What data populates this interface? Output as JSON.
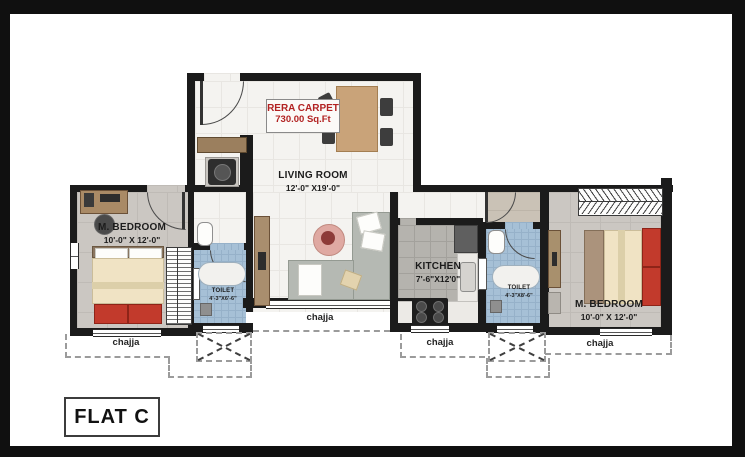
{
  "flat_label": "FLAT C",
  "rera": {
    "title": "RERA CARPET",
    "area": "730.00 Sq.Ft"
  },
  "rooms": {
    "living": {
      "name": "LIVING ROOM",
      "dims": "12'-0\" X19'-0\""
    },
    "bedroom_left": {
      "name": "M. BEDROOM",
      "dims": "10'-0\" X 12'-0\""
    },
    "toilet_left": {
      "name": "TOILET",
      "dims": "4'-3\"X6'-6\""
    },
    "kitchen": {
      "name": "KITCHEN",
      "dims": "7'-6\"X12'0\""
    },
    "toilet_right": {
      "name": "TOILET",
      "dims": "4'-3\"X8'-6\""
    },
    "bedroom_right": {
      "name": "M. BEDROOM",
      "dims": "10'-0\" X 12'-0\""
    }
  },
  "chajja": [
    "chajja",
    "chajja",
    "chajja",
    "chajja"
  ],
  "colors": {
    "wall": "#1b1b1b",
    "living_floor": "#f4f3f0",
    "bedroom_floor": "#cbc7c2",
    "kitchen_floor": "#b5b3ae",
    "toilet_floor": "#a6c0d6",
    "accent_red": "#c23a2c",
    "label_red": "#b22222",
    "wood": "#c9a379"
  }
}
